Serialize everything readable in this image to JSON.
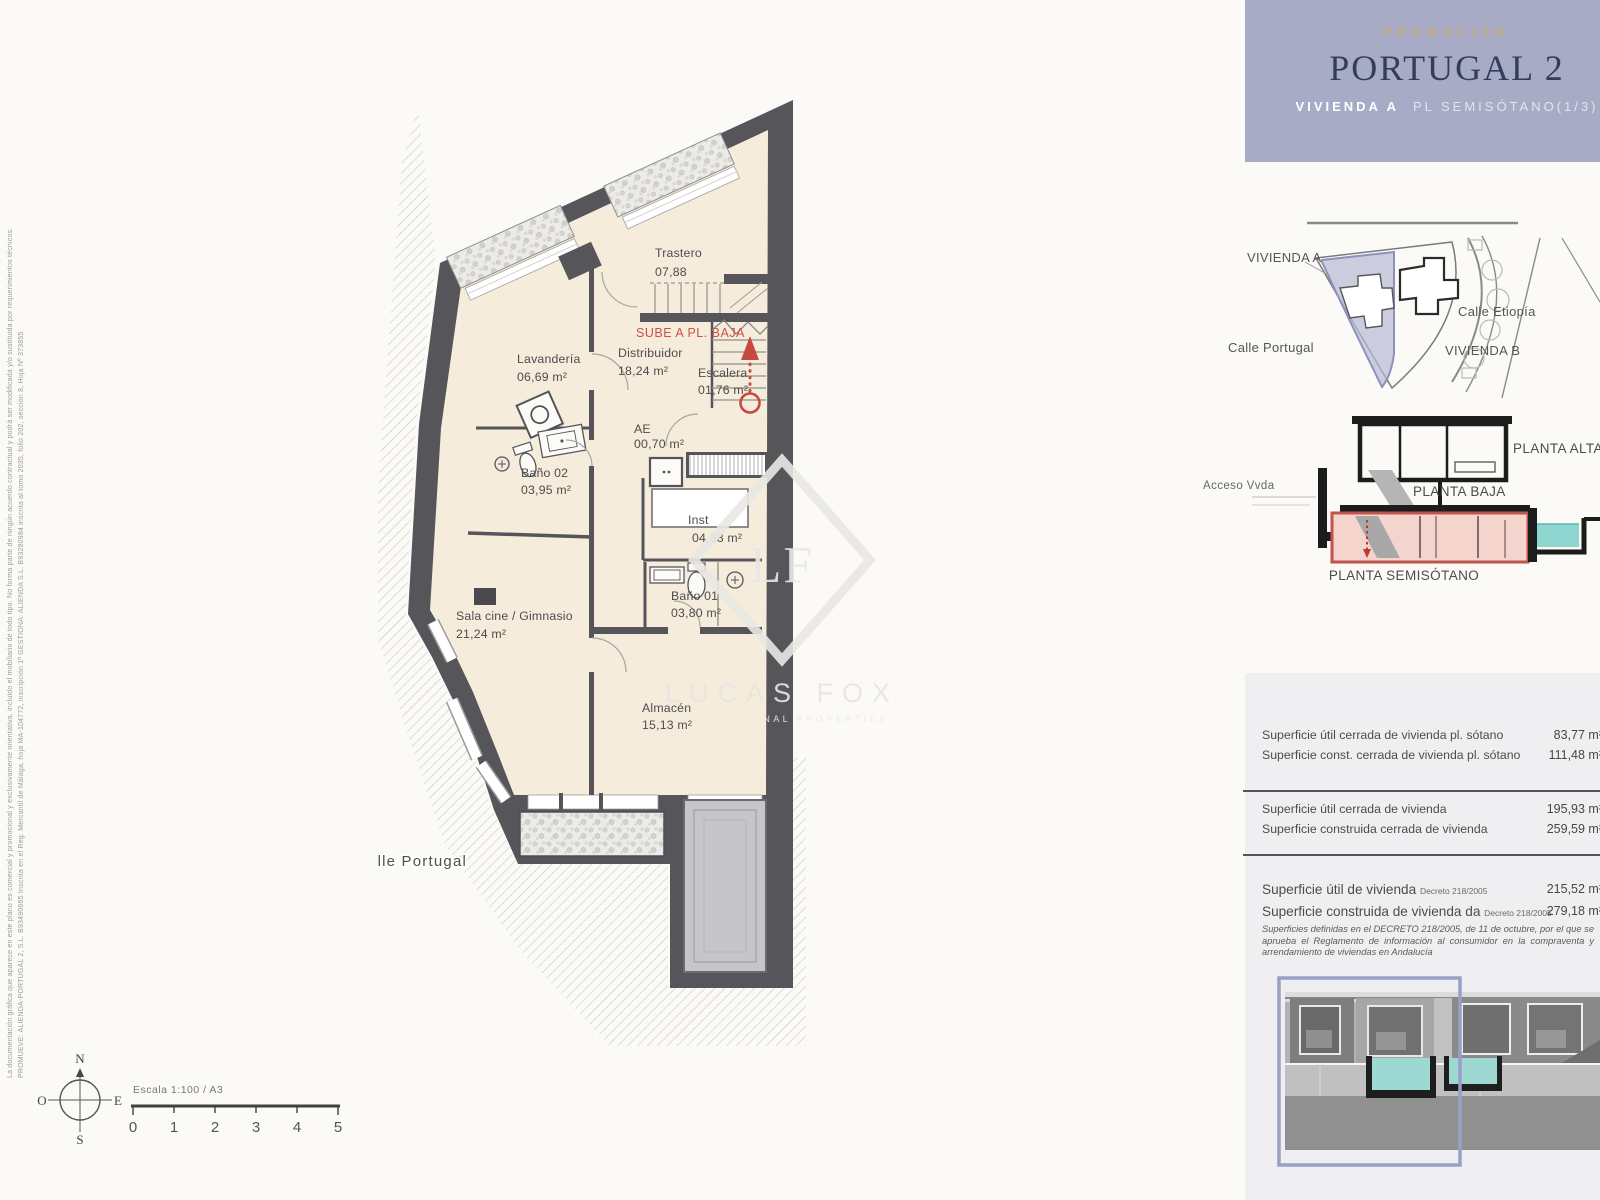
{
  "header": {
    "eyebrow": "PROMOCIÓN",
    "title": "PORTUGAL 2",
    "unit": "VIVIENDA A",
    "floor": "PL SEMISÓTANO(1/3)",
    "accent_bg": "#a7abc6",
    "accent_gold": "#c6ab7e",
    "accent_navy": "#323d5b"
  },
  "site_plan": {
    "vivienda_a": "VIVIENDA A",
    "calle_etiopia": "Calle Etiopía",
    "calle_portugal": "Calle Portugal",
    "vivienda_b": "VIVIENDA B",
    "highlight_color": "#b6b9d6"
  },
  "section": {
    "acceso": "Acceso Vvda",
    "planta_alta": "PLANTA ALTA",
    "planta_baja": "PLANTA BAJA",
    "planta_semisotano": "PLANTA SEMISÓTANO",
    "highlight_color": "#f4d4cd",
    "highlight_border": "#bf544c",
    "pool_color": "#8ed7d1"
  },
  "floor_plan": {
    "stair_note": "SUBE A PL. BAJA",
    "street_label": "Calle Portugal",
    "wall_color": "#56565a",
    "floor_color": "#f6ecdc",
    "red_color": "#c8493f",
    "rooms": {
      "trastero": {
        "name": "Trastero",
        "area": "07,88"
      },
      "lavanderia": {
        "name": "Lavandería",
        "area": "06,69 m²"
      },
      "distribuidor": {
        "name": "Distribuidor",
        "area": "18,24 m²"
      },
      "escalera": {
        "name": "Escalera",
        "area": "01,76 m²"
      },
      "ae": {
        "name": "AE",
        "area": "00,70 m²"
      },
      "bano02": {
        "name": "Baño 02",
        "area": "03,95 m²"
      },
      "inst": {
        "name": "Inst",
        "area": "04,38 m²"
      },
      "bano01": {
        "name": "Baño 01",
        "area": "03,80 m²"
      },
      "sala_cine": {
        "name": "Sala cine / Gimnasio",
        "area": "21,24 m²"
      },
      "almacen": {
        "name": "Almacén",
        "area": "15,13 m²"
      }
    }
  },
  "areas_table": {
    "rows_sotano": [
      {
        "label": "Superficie útil cerrada de vivienda pl. sótano",
        "value": "83,77 m²"
      },
      {
        "label": "Superficie const. cerrada de vivienda pl. sótano",
        "value": "111,48 m²"
      }
    ],
    "rows_vivienda": [
      {
        "label": "Superficie útil cerrada de vivienda",
        "value": "195,93 m²"
      },
      {
        "label": "Superficie construida cerrada de vivienda",
        "value": "259,59 m²"
      }
    ],
    "rows_decreto": [
      {
        "label": "Superficie útil de vivienda",
        "decree": "Decreto 218/2005",
        "value": "215,52 m²"
      },
      {
        "label": "Superficie construida de vivienda da",
        "decree": "Decreto 218/2005",
        "value": "279,18 m²"
      }
    ],
    "note": "Superficies definidas en el DECRETO 218/2005, de 11 de octubre, por el que se aprueba el Reglamento de información al consumidor en la compraventa y arrendamiento de viviendas en Andalucía"
  },
  "compass": {
    "n": "N",
    "s": "S",
    "e": "E",
    "o": "O"
  },
  "scale_bar": {
    "label": "Escala 1:100 / A3",
    "ticks": [
      "0",
      "1",
      "2",
      "3",
      "4",
      "5"
    ]
  },
  "legal": {
    "line1": "La documentación gráfica que aparece en este plano es comercial y promocional y exclusivamente orientativa, incluido el mobiliario de todo tipo. No forma parte de ningún acuerdo contractual y podrá ser modificada y/o sustituida por requerimientos técnicos.",
    "line2": "PROMUEVE: ALIENDA-PORTUGAL 2, S.L.  B93490665 Inscrita en el Reg. Mercantil de Málaga, hoja MA-104772, inscripción 1ª      GESTIONA: ALIENDA S.L.  B93280984 inscrita al tomo 2035, folio 202, sección 8, Hoja Nº 373855"
  },
  "watermark": {
    "initials": "LF",
    "name": "LUCAS FOX",
    "tagline": "INTERNATIONAL PROPERTIES"
  }
}
